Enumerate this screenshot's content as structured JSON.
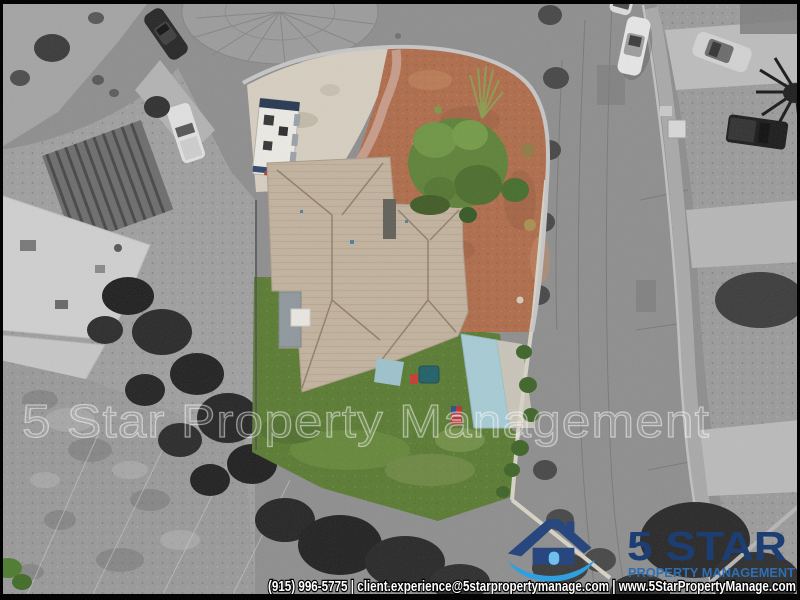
{
  "watermark": {
    "text": "5 Star Property Management"
  },
  "logo": {
    "brand": "5 STAR",
    "tagline": "PROPERTY MANAGEMENT",
    "brand_color": "#1d3e73",
    "tagline_color": "#2e6fb3",
    "swoosh_color": "#2f9fe0"
  },
  "footer": {
    "contact_line": "(915) 996-5775 | client.experience@5starpropertymanage.com | www.5StarPropertyManage.com"
  },
  "palette": {
    "street_gray": "#8d8d8d",
    "roof_tan": "#c2b29e",
    "lawn_green": "#587a30",
    "desert_rust": "#ae6b49",
    "patio_teal": "#a6cbd4",
    "driveway_concrete": "#d6cec0"
  }
}
